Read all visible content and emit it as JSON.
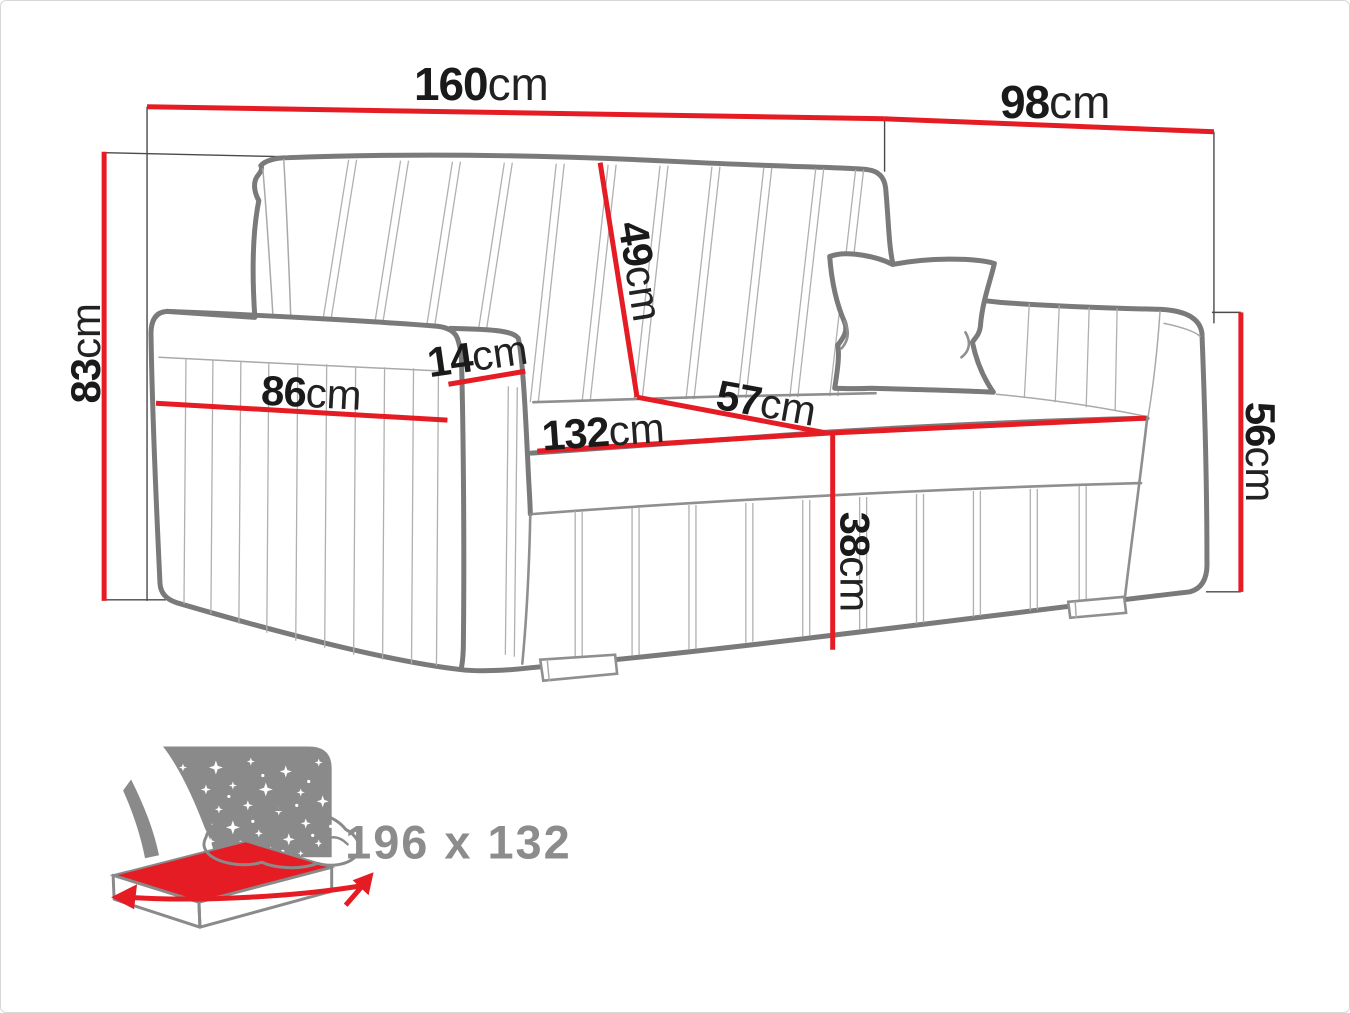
{
  "diagram": {
    "type": "furniture-dimension-diagram",
    "subject": "sofa-bed technical drawing",
    "units": "cm",
    "dimensions": {
      "total_width": {
        "value": "160",
        "unit": "cm"
      },
      "total_depth": {
        "value": "98",
        "unit": "cm"
      },
      "total_height": {
        "value": "83",
        "unit": "cm"
      },
      "backrest_height": {
        "value": "49",
        "unit": "cm"
      },
      "armrest_width": {
        "value": "14",
        "unit": "cm"
      },
      "armrest_length": {
        "value": "86",
        "unit": "cm"
      },
      "seat_width": {
        "value": "132",
        "unit": "cm"
      },
      "seat_depth": {
        "value": "57",
        "unit": "cm"
      },
      "base_height": {
        "value": "38",
        "unit": "cm"
      },
      "armrest_height": {
        "value": "56",
        "unit": "cm"
      }
    },
    "sleeping_function": {
      "icon": "sofa-bed-sleeping-icon",
      "size_label": "196 x 132"
    },
    "colors": {
      "dimension_line": "#e61c24",
      "outline_gray": "#7a7a7a",
      "label_text": "#1a1a1a",
      "icon_gray": "#8a8a8a"
    }
  }
}
